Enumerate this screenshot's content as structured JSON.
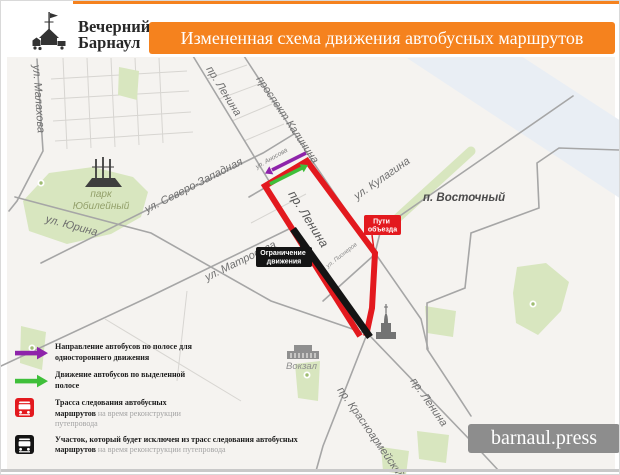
{
  "header": {
    "logo_line1": "Вечерний",
    "logo_line2": "Барнаул",
    "banner": "Измененная схема движения автобусных маршрутов"
  },
  "map": {
    "labels": {
      "malakhova": "ул. Малахова",
      "park_line1": "парк",
      "park_line2": "Юбилейный",
      "yurina": "ул. Юрина",
      "severo_zapadnaya": "ул. Северо-Западная",
      "lenina_top": "пр. Ленина",
      "kalinina": "проспект Калинина",
      "anosova": "ул. Аносова",
      "lenina_mid": "пр. Ленина",
      "matrosova": "ул. Матросова",
      "kulagina": "ул. Кулагина",
      "vostochny": "п. Восточный",
      "pionerov": "ул. Пионеров",
      "vokzal": "Вокзал",
      "krasnoarmeysky": "пр. Красноармейский",
      "lenina_bottom": "пр. Ленина"
    },
    "badges": {
      "detour_line1": "Пути",
      "detour_line2": "объезда",
      "restriction_line1": "Ограничение",
      "restriction_line2": "движения"
    }
  },
  "legend": {
    "items": [
      {
        "bold": "Направление автобусов по полосе для одностороннего движения",
        "gray": ""
      },
      {
        "bold": "Движение автобусов по выделенной полосе",
        "gray": ""
      },
      {
        "bold": "Трасса следования автобусных маршрутов",
        "gray": " на время реконструкции путепровода"
      },
      {
        "bold": "Участок, который будет исключен  из трасс следования автобусных маршрутов",
        "gray": " на время реконструкции путепровода"
      }
    ]
  },
  "footer": {
    "site": "barnaul.press"
  },
  "colors": {
    "accent_orange": "#F5821E",
    "route_red": "#E3191E",
    "closed_black": "#141414",
    "oneway_purple": "#8E24AA",
    "lane_green": "#3FBF3A",
    "site_badge_gray": "#8D8D8D"
  }
}
